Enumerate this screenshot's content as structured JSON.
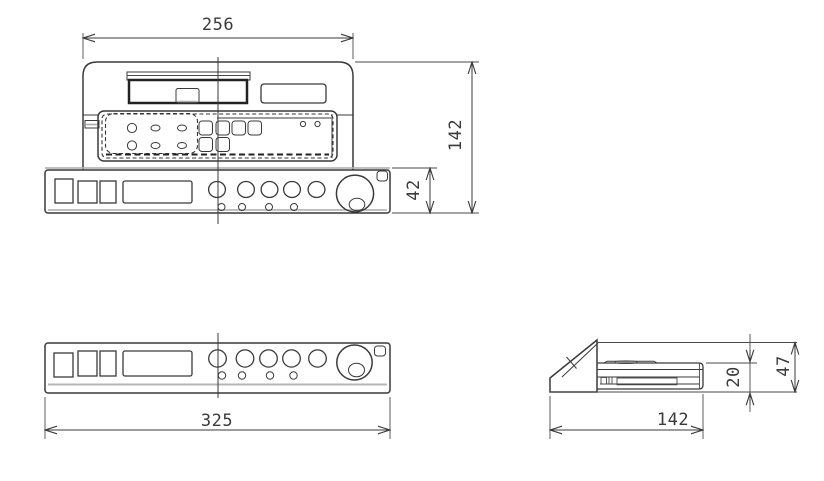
{
  "drawing": {
    "colors": {
      "line": "#3a3a3a",
      "light_line": "#ababab",
      "background": "#ffffff"
    },
    "views": {
      "top_front": {
        "dims": {
          "overall_width": "256",
          "overall_depth": "142",
          "panel_depth": "42"
        }
      },
      "front": {
        "dims": {
          "overall_width": "325"
        }
      },
      "side": {
        "dims": {
          "overall_depth": "142",
          "chassis_height": "20",
          "overall_height": "47"
        }
      }
    }
  }
}
